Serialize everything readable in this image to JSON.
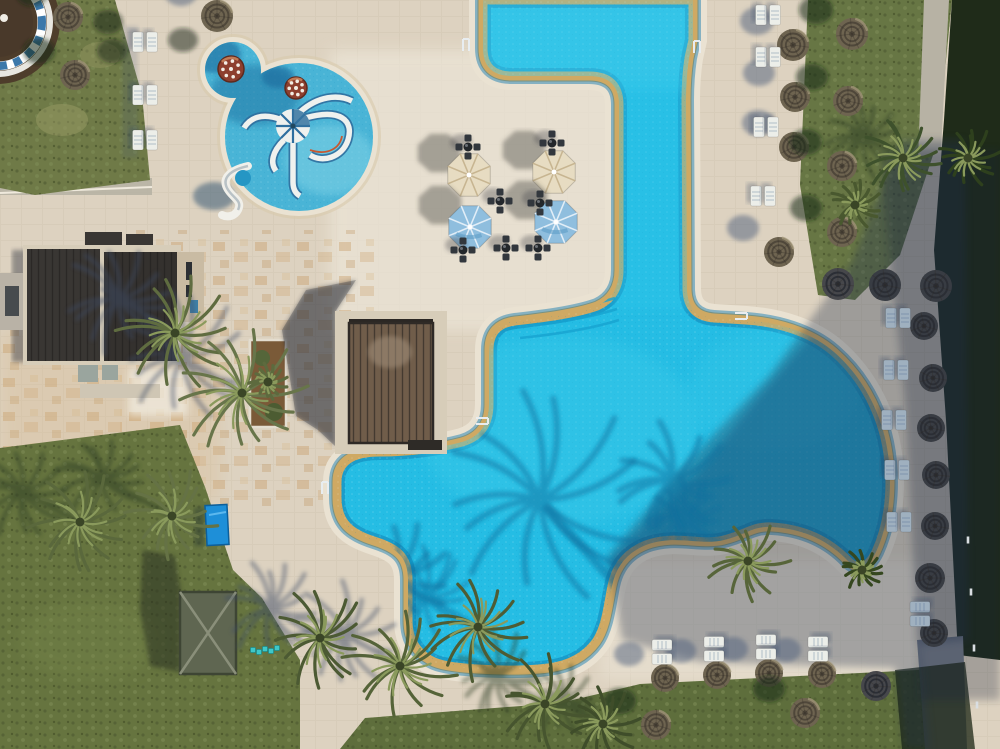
{
  "meta": {
    "title": "Aerial drone view of a resort swimming pool complex",
    "scene": "aerial-photo",
    "features": [
      "main-free-form-pool",
      "kids-pool-with-octopus-slide",
      "mushroom-fountains",
      "cafe-terrace",
      "pergola",
      "thatch-umbrellas",
      "sun-loungers",
      "palm-trees",
      "lawns",
      "beach-hut"
    ]
  },
  "palette": {
    "water": "#25bde4",
    "waterGlint": "#4ed2ee",
    "waterDeep": "#0b76ac",
    "waterShade": "#0a6da0",
    "waterKids": "#49b4d6",
    "waterKidsLight": "#7ed2e6",
    "paving": "#ddd2c0",
    "pavingLight": "#efe9dc",
    "pavingTan": "#d8bd96",
    "pavingPink": "#e6d8c6",
    "coping": "#cfa963",
    "poolRing": "#eae2d2",
    "grass": "#6f7a47",
    "grassLawn": "#66743f",
    "grassStrip": "#5e6e3c",
    "grassWorn": "#9a9b66",
    "hedge": "#1f2b19",
    "shadow": "#36445f",
    "roof": "#393633",
    "roofLine": "#1f1d1b",
    "pergolaRoof": "#705d4a",
    "pergolaFrame": "#d7cdb9",
    "pergolaSlat": "#52443a",
    "thatchSun": "#6e6450",
    "thatchRing": "#4f473a",
    "thatchShade": "#46474b",
    "thatchDark": "#383c43",
    "thatchHi": "#a59a7c",
    "lounger": "#eceee9",
    "loungerShade": "#9fb0bf",
    "umbrellaCream": "#e7dcc2",
    "umbrellaCreamRib": "#c4b18c",
    "umbrellaBlue": "#8fbede",
    "umbrellaBlueRib": "#eaf3fa",
    "furniture": "#32373d",
    "hut": "#5f6651",
    "hutLine": "#3e4534",
    "planterSoil": "#7a5a38",
    "pathGray": "#b7b2a4",
    "walkway": "#777d88",
    "slide": "#f1f0ea",
    "mushroom": "#8d3f2e",
    "structureThatch": "#4e3d2b",
    "structureBlue": "#3c78aa",
    "tealChair": "#3fc8c8",
    "octoWhite": "#eff1ee",
    "octoBlue": "#2f6f9f",
    "octoOrange": "#c9572e"
  },
  "objects": {
    "thatch_umbrellas": [
      {
        "x": 68,
        "y": 17,
        "r": 15,
        "v": "sun",
        "surf": "grass"
      },
      {
        "x": 75,
        "y": 75,
        "r": 15,
        "v": "sun",
        "surf": "grass"
      },
      {
        "x": 217,
        "y": 16,
        "r": 16,
        "v": "sun",
        "surf": "paving"
      },
      {
        "x": 793,
        "y": 45,
        "r": 16,
        "v": "sun",
        "surf": "paving"
      },
      {
        "x": 795,
        "y": 97,
        "r": 15,
        "v": "sun",
        "surf": "paving"
      },
      {
        "x": 794,
        "y": 147,
        "r": 15,
        "v": "sun",
        "surf": "paving"
      },
      {
        "x": 852,
        "y": 34,
        "r": 16,
        "v": "sun",
        "surf": "grass"
      },
      {
        "x": 848,
        "y": 101,
        "r": 15,
        "v": "sun",
        "surf": "grass"
      },
      {
        "x": 842,
        "y": 166,
        "r": 15,
        "v": "sun",
        "surf": "grass"
      },
      {
        "x": 842,
        "y": 232,
        "r": 15,
        "v": "sun",
        "surf": "grass"
      },
      {
        "x": 779,
        "y": 252,
        "r": 15,
        "v": "sun",
        "surf": "paving"
      },
      {
        "x": 838,
        "y": 284,
        "r": 16,
        "v": "shade",
        "surf": "paving"
      },
      {
        "x": 885,
        "y": 285,
        "r": 16,
        "v": "dark",
        "surf": "paving"
      },
      {
        "x": 936,
        "y": 286,
        "r": 16,
        "v": "dark",
        "surf": "paving"
      },
      {
        "x": 924,
        "y": 326,
        "r": 14,
        "v": "dark",
        "surf": "paving"
      },
      {
        "x": 933,
        "y": 378,
        "r": 14,
        "v": "dark",
        "surf": "paving"
      },
      {
        "x": 931,
        "y": 428,
        "r": 14,
        "v": "dark",
        "surf": "paving"
      },
      {
        "x": 936,
        "y": 475,
        "r": 14,
        "v": "dark",
        "surf": "paving"
      },
      {
        "x": 935,
        "y": 526,
        "r": 14,
        "v": "dark",
        "surf": "paving"
      },
      {
        "x": 930,
        "y": 578,
        "r": 15,
        "v": "dark",
        "surf": "paving"
      },
      {
        "x": 934,
        "y": 633,
        "r": 14,
        "v": "dark",
        "surf": "paving"
      },
      {
        "x": 876,
        "y": 686,
        "r": 15,
        "v": "shade",
        "surf": "paving"
      },
      {
        "x": 665,
        "y": 678,
        "r": 14,
        "v": "sun",
        "surf": "paving"
      },
      {
        "x": 717,
        "y": 675,
        "r": 14,
        "v": "sun",
        "surf": "paving"
      },
      {
        "x": 769,
        "y": 673,
        "r": 14,
        "v": "sun",
        "surf": "paving"
      },
      {
        "x": 822,
        "y": 674,
        "r": 14,
        "v": "sun",
        "surf": "paving"
      },
      {
        "x": 656,
        "y": 725,
        "r": 15,
        "v": "sun",
        "surf": "grass"
      },
      {
        "x": 805,
        "y": 713,
        "r": 15,
        "v": "sun",
        "surf": "grass"
      }
    ],
    "fabric_umbrellas": [
      {
        "x": 469,
        "y": 175,
        "r": 23,
        "kind": "cream"
      },
      {
        "x": 554,
        "y": 172,
        "r": 23,
        "kind": "cream"
      },
      {
        "x": 470,
        "y": 227,
        "r": 23,
        "kind": "blue"
      },
      {
        "x": 556,
        "y": 222,
        "r": 23,
        "kind": "blue"
      }
    ],
    "lounger_pairs": [
      {
        "x": 145,
        "y": 42,
        "rot": 0,
        "v": "sun"
      },
      {
        "x": 145,
        "y": 95,
        "rot": 0,
        "v": "sun"
      },
      {
        "x": 145,
        "y": 140,
        "rot": 0,
        "v": "sun"
      },
      {
        "x": 768,
        "y": 15,
        "rot": 0,
        "v": "sun"
      },
      {
        "x": 768,
        "y": 57,
        "rot": 0,
        "v": "sun"
      },
      {
        "x": 766,
        "y": 127,
        "rot": 0,
        "v": "sun"
      },
      {
        "x": 763,
        "y": 196,
        "rot": 0,
        "v": "sun"
      },
      {
        "x": 898,
        "y": 318,
        "rot": 0,
        "v": "dark"
      },
      {
        "x": 896,
        "y": 370,
        "rot": 0,
        "v": "dark"
      },
      {
        "x": 894,
        "y": 420,
        "rot": 0,
        "v": "dark"
      },
      {
        "x": 897,
        "y": 470,
        "rot": 0,
        "v": "dark"
      },
      {
        "x": 899,
        "y": 522,
        "rot": 0,
        "v": "dark"
      },
      {
        "x": 662,
        "y": 652,
        "rot": 90,
        "v": "sun"
      },
      {
        "x": 714,
        "y": 649,
        "rot": 90,
        "v": "sun"
      },
      {
        "x": 766,
        "y": 647,
        "rot": 90,
        "v": "sun"
      },
      {
        "x": 818,
        "y": 649,
        "rot": 90,
        "v": "sun"
      },
      {
        "x": 920,
        "y": 614,
        "rot": 90,
        "v": "dark"
      }
    ],
    "cafe_tables": [
      {
        "x": 468,
        "y": 147
      },
      {
        "x": 552,
        "y": 143
      },
      {
        "x": 500,
        "y": 201
      },
      {
        "x": 540,
        "y": 203
      },
      {
        "x": 463,
        "y": 250
      },
      {
        "x": 506,
        "y": 248
      },
      {
        "x": 538,
        "y": 248
      }
    ],
    "palms": [
      {
        "x": 175,
        "y": 333,
        "r": 62,
        "c": "#5f6c40",
        "sx": -56,
        "sy": -34,
        "shadowOn": "paving"
      },
      {
        "x": 242,
        "y": 393,
        "r": 70,
        "c": "#68754a",
        "sx": -60,
        "sy": -36,
        "shadowOn": "paving"
      },
      {
        "x": 80,
        "y": 522,
        "r": 55,
        "c": "#5a683c",
        "sx": -58,
        "sy": -30,
        "shadowOn": "grass"
      },
      {
        "x": 172,
        "y": 516,
        "r": 48,
        "c": "#657245",
        "sx": -70,
        "sy": -38,
        "shadowOn": "grass"
      },
      {
        "x": 320,
        "y": 638,
        "r": 52,
        "c": "#4c5a33",
        "sx": -50,
        "sy": -30,
        "shadowOn": "paving"
      },
      {
        "x": 400,
        "y": 666,
        "r": 58,
        "c": "#556338",
        "sx": -55,
        "sy": -32,
        "shadowOn": "paving"
      },
      {
        "x": 478,
        "y": 627,
        "r": 55,
        "c": "#4e5c34",
        "sx": -52,
        "sy": -30,
        "shadowOn": "paving"
      },
      {
        "x": 545,
        "y": 704,
        "r": 50,
        "c": "#47552f",
        "sx": -48,
        "sy": -28,
        "shadowOn": "grass"
      },
      {
        "x": 603,
        "y": 724,
        "r": 38,
        "c": "#3f4d2a",
        "sx": -40,
        "sy": -24,
        "shadowOn": "grass"
      },
      {
        "x": 748,
        "y": 561,
        "r": 42,
        "c": "#57653a",
        "sx": -66,
        "sy": -44,
        "shadowOn": "paving"
      },
      {
        "x": 903,
        "y": 158,
        "r": 45,
        "c": "#3e512c",
        "sx": -40,
        "sy": -22,
        "shadowOn": "grass"
      },
      {
        "x": 855,
        "y": 205,
        "r": 26,
        "c": "#49582f",
        "sx": 0,
        "sy": 0,
        "shadowOn": "none"
      },
      {
        "x": 862,
        "y": 570,
        "r": 22,
        "c": "#35471f",
        "sx": 0,
        "sy": 0,
        "shadowOn": "none"
      },
      {
        "x": 968,
        "y": 158,
        "r": 32,
        "c": "#2e401d",
        "sx": 0,
        "sy": 0,
        "shadowOn": "none"
      },
      {
        "x": 268,
        "y": 382,
        "r": 20,
        "c": "#5d6a3e",
        "sx": 0,
        "sy": 0,
        "shadowOn": "none"
      }
    ],
    "water_shadow_palms": [
      {
        "x": 540,
        "y": 500,
        "r": 110
      },
      {
        "x": 672,
        "y": 480,
        "r": 62
      },
      {
        "x": 395,
        "y": 575,
        "r": 55
      },
      {
        "x": 350,
        "y": 82,
        "r": 40
      }
    ],
    "mushroom_fountains": [
      {
        "x": 231,
        "y": 69,
        "r": 13
      },
      {
        "x": 296,
        "y": 88,
        "r": 11
      }
    ],
    "pool_ladders": [
      {
        "x": 466,
        "y": 45,
        "rot": 0
      },
      {
        "x": 697,
        "y": 47,
        "rot": 0
      },
      {
        "x": 741,
        "y": 316,
        "rot": 90
      },
      {
        "x": 325,
        "y": 488,
        "rot": 0
      },
      {
        "x": 482,
        "y": 421,
        "rot": 90
      }
    ],
    "kids_chairs": [
      {
        "x": 253,
        "y": 650
      },
      {
        "x": 259,
        "y": 652
      },
      {
        "x": 265,
        "y": 649
      },
      {
        "x": 271,
        "y": 651
      },
      {
        "x": 277,
        "y": 648
      }
    ],
    "fence_posts": [
      {
        "x": 971,
        "y": 592
      },
      {
        "x": 974,
        "y": 648
      },
      {
        "x": 977,
        "y": 705
      },
      {
        "x": 968,
        "y": 540
      }
    ],
    "stray_shadows": [
      {
        "x": 108,
        "y": 22
      },
      {
        "x": 112,
        "y": 51
      },
      {
        "x": 183,
        "y": 40
      }
    ]
  }
}
